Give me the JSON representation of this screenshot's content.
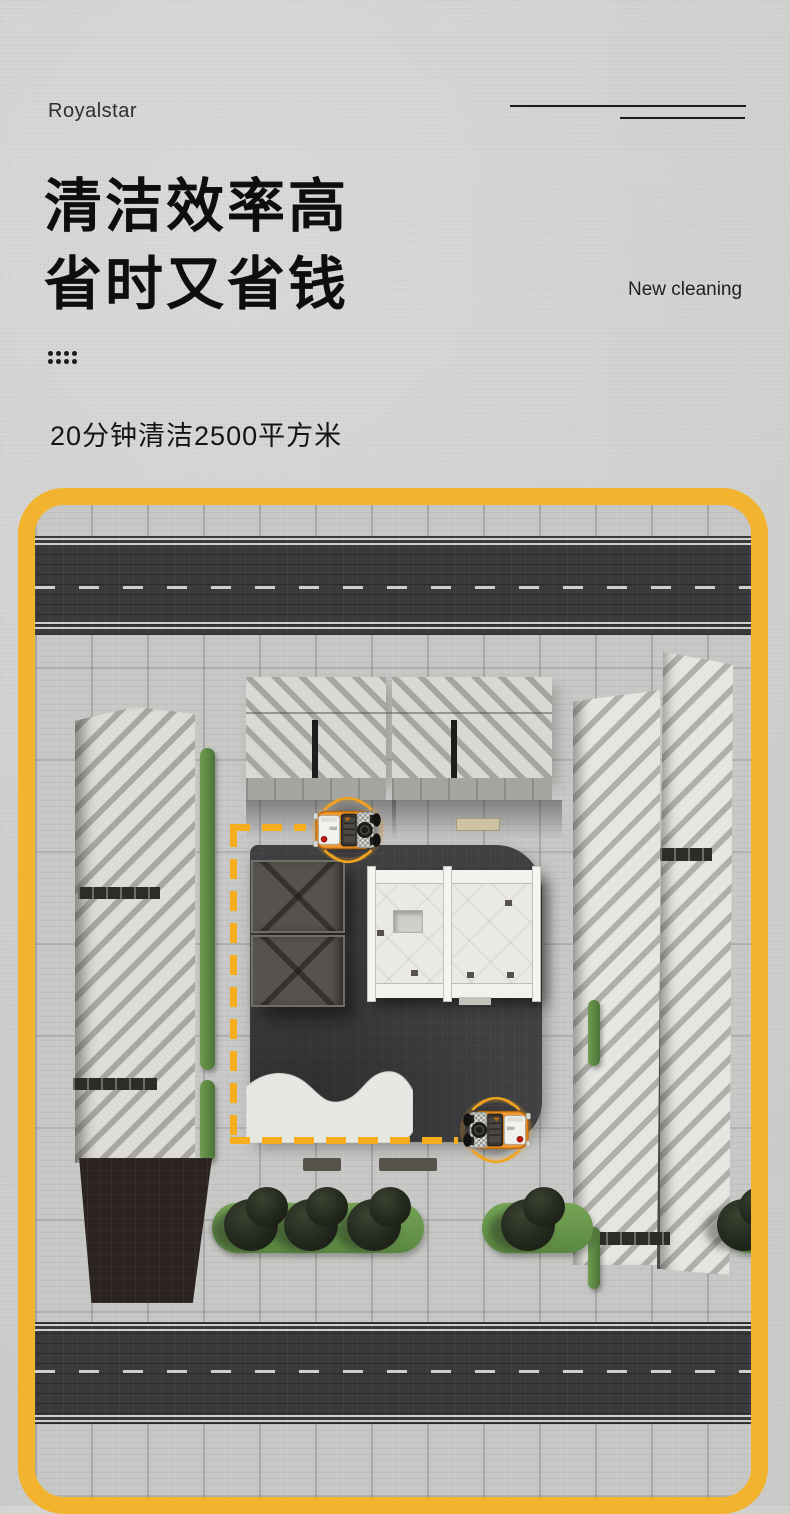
{
  "brand": {
    "logo_text": "Royalstar"
  },
  "hero": {
    "title_line1": "清洁效率高",
    "title_line2": "省时又省钱",
    "tagline_en": "New cleaning",
    "subtitle": "20分钟清洁2500平方米"
  },
  "colors": {
    "accent_yellow": "#F2B42F",
    "path_dash_yellow": "#F6AE1C",
    "machine_orange": "#EE8D1D",
    "background_gray": "#D2D2D0",
    "road_dark": "#3A393B",
    "grass_green": "#6B9B4F",
    "plaza_dark": "#403F41",
    "text_black": "#0E0E0E"
  },
  "illustration": {
    "type": "aerial plaza cleaning scene",
    "machines": [
      {
        "name": "robot-floor-scrubber-top",
        "facing": "left"
      },
      {
        "name": "robot-floor-scrubber-bottom",
        "facing": "right"
      }
    ],
    "path": "dashed yellow cleaning route between the two machines"
  }
}
